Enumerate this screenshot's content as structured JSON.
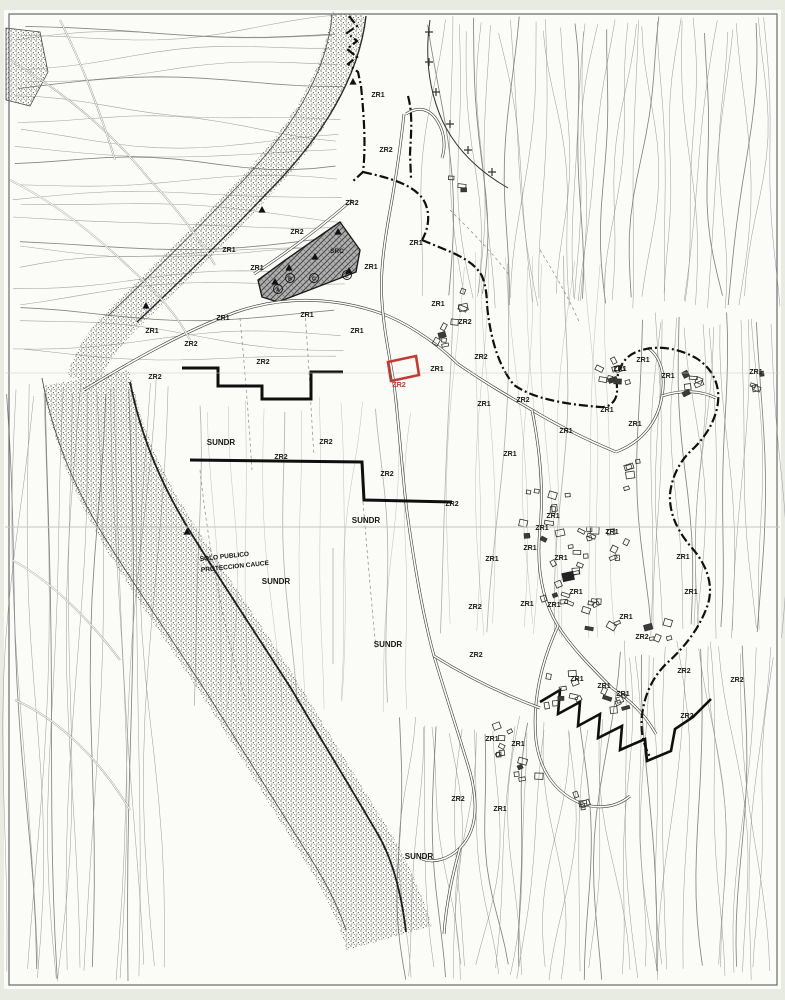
{
  "map": {
    "description": "Scanned black-and-white municipal zoning plan with topographic contours",
    "colors": {
      "paper": "#fbfbf8",
      "margin": "#e7ebe2",
      "ink": "#1a1a1a",
      "contour": "#8f8f8f",
      "highlight_red": "#c23b33"
    },
    "highlight_parcel": {
      "label": "ZR2",
      "label_x": 399,
      "label_y": 387,
      "color": "#c23b33"
    },
    "band_annotation": {
      "line1": "SOLO PUBLICO",
      "line2": "PROTECCION CAUCE",
      "x": 200,
      "y": 561
    },
    "zone_labels": [
      {
        "t": "ZR1",
        "x": 378,
        "y": 97
      },
      {
        "t": "ZR2",
        "x": 386,
        "y": 152
      },
      {
        "t": "ZR2",
        "x": 352,
        "y": 205
      },
      {
        "t": "ZR2",
        "x": 297,
        "y": 234
      },
      {
        "t": "ZR1",
        "x": 416,
        "y": 245
      },
      {
        "t": "SRC",
        "x": 337,
        "y": 253,
        "s": 6.5
      },
      {
        "t": "ZR1",
        "x": 257,
        "y": 270
      },
      {
        "t": "ZR1",
        "x": 371,
        "y": 269
      },
      {
        "t": "ZR1",
        "x": 229,
        "y": 252
      },
      {
        "t": "ZR1",
        "x": 152,
        "y": 333
      },
      {
        "t": "ZR1",
        "x": 223,
        "y": 320
      },
      {
        "t": "ZR1",
        "x": 307,
        "y": 317
      },
      {
        "t": "ZR1",
        "x": 357,
        "y": 333
      },
      {
        "t": "ZR2",
        "x": 191,
        "y": 346
      },
      {
        "t": "ZR2",
        "x": 263,
        "y": 364
      },
      {
        "t": "ZR2",
        "x": 155,
        "y": 379
      },
      {
        "t": "ZR1",
        "x": 438,
        "y": 306
      },
      {
        "t": "ZR2",
        "x": 465,
        "y": 324
      },
      {
        "t": "ZR2",
        "x": 481,
        "y": 359
      },
      {
        "t": "ZR1",
        "x": 437,
        "y": 371
      },
      {
        "t": "ZR1",
        "x": 484,
        "y": 406
      },
      {
        "t": "ZR2",
        "x": 523,
        "y": 402
      },
      {
        "t": "ZR1",
        "x": 510,
        "y": 456
      },
      {
        "t": "ZR1",
        "x": 566,
        "y": 433
      },
      {
        "t": "ZR1",
        "x": 607,
        "y": 412
      },
      {
        "t": "ZR1",
        "x": 620,
        "y": 371
      },
      {
        "t": "ZR1",
        "x": 643,
        "y": 362
      },
      {
        "t": "ZR1",
        "x": 668,
        "y": 378
      },
      {
        "t": "ZR1",
        "x": 635,
        "y": 426
      },
      {
        "t": "ZR1",
        "x": 756,
        "y": 374
      },
      {
        "t": "SUNDR",
        "x": 221,
        "y": 445,
        "s": 8
      },
      {
        "t": "ZR2",
        "x": 281,
        "y": 459
      },
      {
        "t": "ZR2",
        "x": 326,
        "y": 444
      },
      {
        "t": "ZR2",
        "x": 387,
        "y": 476
      },
      {
        "t": "SUNDR",
        "x": 366,
        "y": 523,
        "s": 8
      },
      {
        "t": "ZR2",
        "x": 452,
        "y": 506
      },
      {
        "t": "ZR1",
        "x": 492,
        "y": 561
      },
      {
        "t": "ZR2",
        "x": 475,
        "y": 609
      },
      {
        "t": "SUNDR",
        "x": 276,
        "y": 584,
        "s": 8
      },
      {
        "t": "SUNDR",
        "x": 388,
        "y": 647,
        "s": 8
      },
      {
        "t": "ZR2",
        "x": 476,
        "y": 657
      },
      {
        "t": "ZR1",
        "x": 553,
        "y": 518
      },
      {
        "t": "ZR1",
        "x": 542,
        "y": 530
      },
      {
        "t": "ZR1",
        "x": 530,
        "y": 550
      },
      {
        "t": "ZR1",
        "x": 612,
        "y": 534
      },
      {
        "t": "ZR1",
        "x": 561,
        "y": 560
      },
      {
        "t": "ZR1",
        "x": 683,
        "y": 559
      },
      {
        "t": "ZR1",
        "x": 576,
        "y": 594
      },
      {
        "t": "ZR1",
        "x": 527,
        "y": 606
      },
      {
        "t": "ZR1",
        "x": 554,
        "y": 607
      },
      {
        "t": "ZR1",
        "x": 691,
        "y": 594
      },
      {
        "t": "ZR1",
        "x": 626,
        "y": 619
      },
      {
        "t": "ZR2",
        "x": 642,
        "y": 639
      },
      {
        "t": "ZR2",
        "x": 684,
        "y": 673
      },
      {
        "t": "ZR2",
        "x": 737,
        "y": 682
      },
      {
        "t": "ZR1",
        "x": 577,
        "y": 681
      },
      {
        "t": "ZR1",
        "x": 604,
        "y": 688
      },
      {
        "t": "ZR1",
        "x": 623,
        "y": 696
      },
      {
        "t": "ZR2",
        "x": 687,
        "y": 718
      },
      {
        "t": "ZR1",
        "x": 492,
        "y": 741
      },
      {
        "t": "ZR1",
        "x": 518,
        "y": 746
      },
      {
        "t": "ZR2",
        "x": 458,
        "y": 801
      },
      {
        "t": "ZR1",
        "x": 500,
        "y": 811
      },
      {
        "t": "SUNDR",
        "x": 419,
        "y": 859,
        "s": 8
      }
    ],
    "markers": {
      "triangles": [
        [
          353,
          82
        ],
        [
          262,
          210
        ],
        [
          146,
          306
        ],
        [
          187,
          532
        ],
        [
          315,
          257
        ],
        [
          289,
          268
        ],
        [
          275,
          282
        ],
        [
          349,
          271
        ],
        [
          338,
          232
        ]
      ],
      "circled_letters": [
        {
          "t": "A",
          "x": 278,
          "y": 291
        },
        {
          "t": "B",
          "x": 290,
          "y": 280
        },
        {
          "t": "C",
          "x": 314,
          "y": 280
        },
        {
          "t": "E",
          "x": 347,
          "y": 277
        }
      ]
    }
  }
}
